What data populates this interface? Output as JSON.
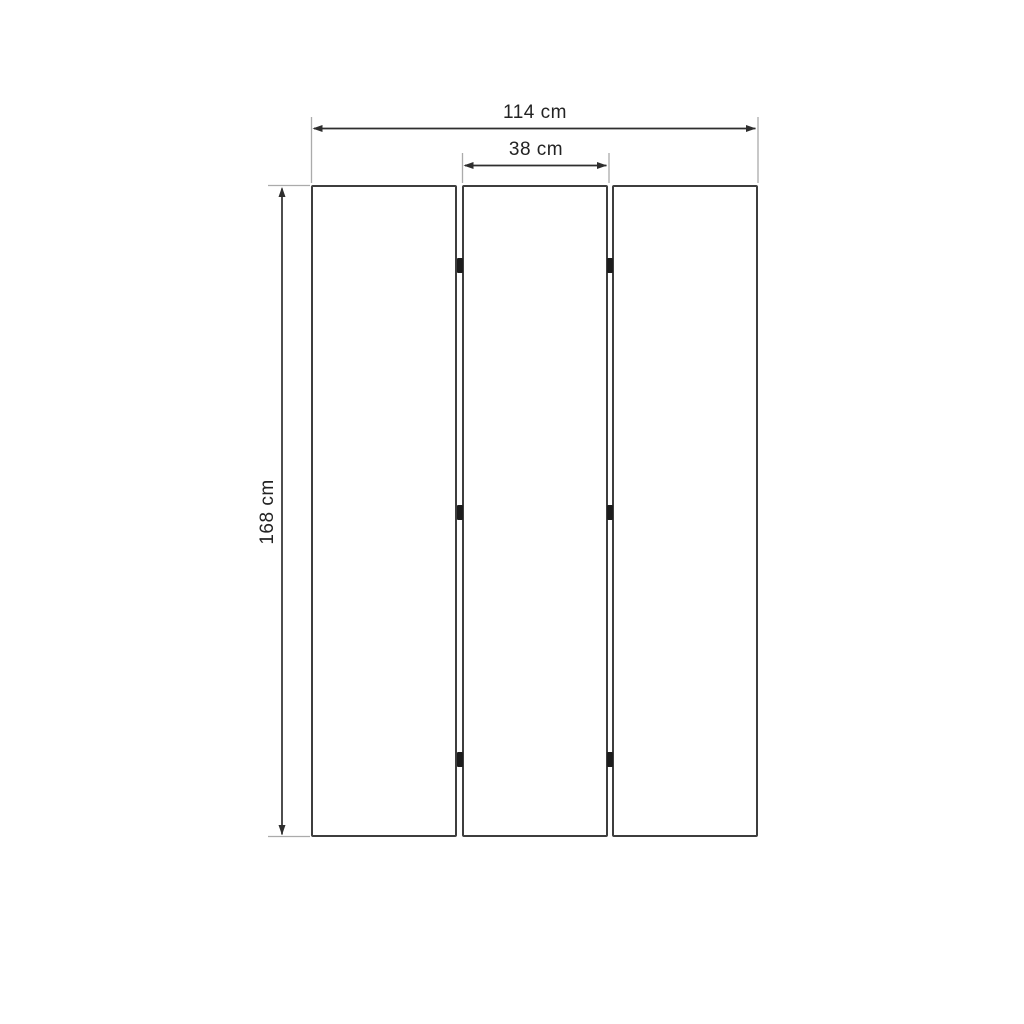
{
  "diagram": {
    "title": "Three-panel folding screen dimension drawing",
    "object": "room divider with 3 panels joined by hinges",
    "panels": {
      "count": 3,
      "hinge_rows_per_gap": 3
    },
    "dimensions": {
      "total_width": {
        "label": "114 cm",
        "value": 114,
        "unit": "cm"
      },
      "panel_width": {
        "label": "38 cm",
        "value": 38,
        "unit": "cm"
      },
      "height": {
        "label": "168 cm",
        "value": 168,
        "unit": "cm"
      }
    },
    "colors": {
      "background": "#ffffff",
      "panel_border": "#3d3d3d",
      "dimension_line": "#2e2e2e",
      "extension_line": "#ababab",
      "hinge": "#1c1c1c",
      "text": "#232323"
    }
  }
}
